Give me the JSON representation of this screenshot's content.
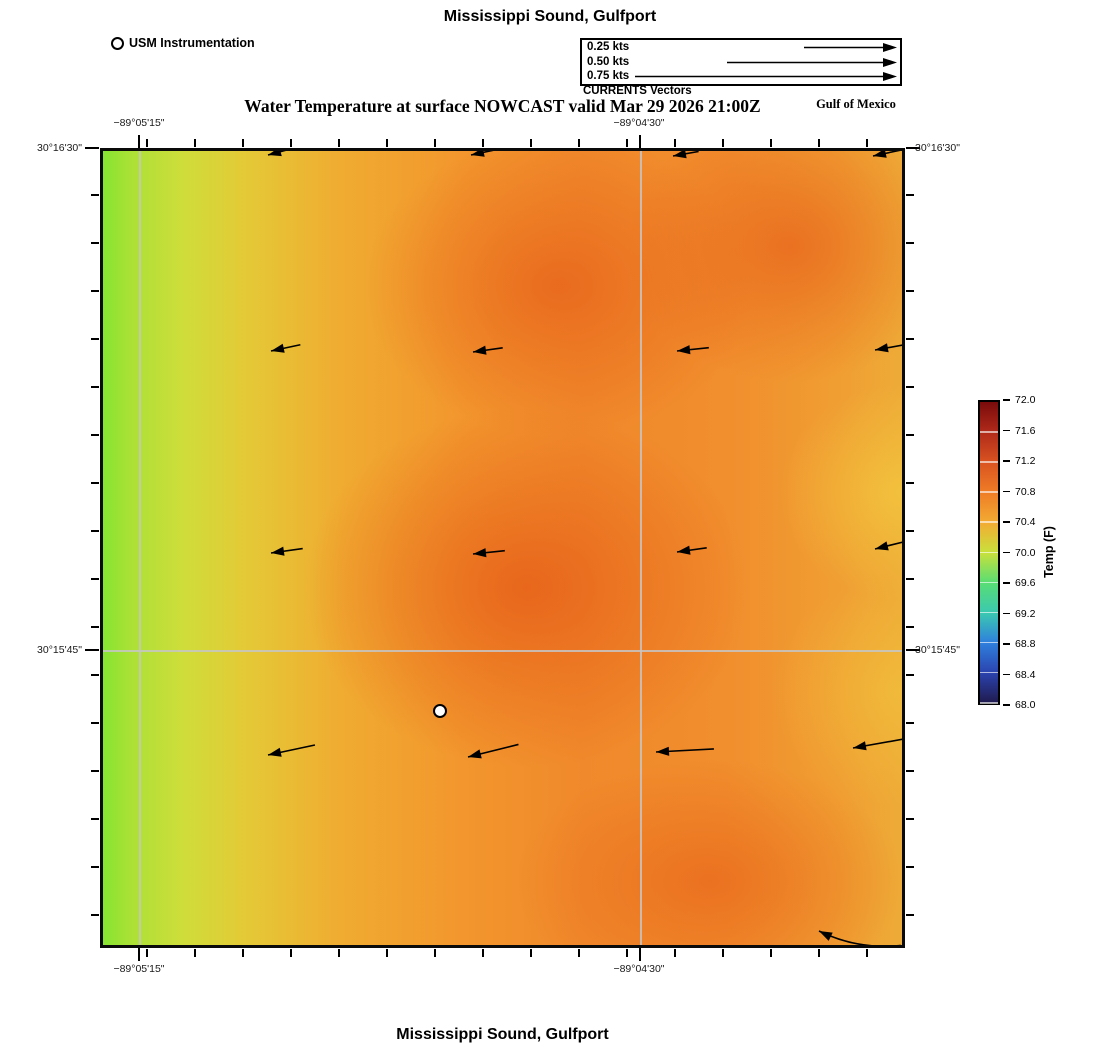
{
  "page": {
    "top_title": "Mississippi Sound, Gulfport",
    "bottom_title": "Mississippi Sound, Gulfport"
  },
  "header": {
    "station_legend": "USM Instrumentation",
    "vector_legend": {
      "caption": "CURRENTS Vectors",
      "speeds": [
        {
          "label": "0.25 kts",
          "tail_px": 93
        },
        {
          "label": "0.50 kts",
          "tail_px": 170
        },
        {
          "label": "0.75 kts",
          "tail_px": 262
        }
      ]
    },
    "subtitle": "Water Temperature at surface NOWCAST valid Mar 29 2026 21:00Z",
    "region_label": "Gulf of Mexico"
  },
  "axes": {
    "lat_top": "30°16'30\"",
    "lat_mid": "30°15'45\"",
    "lon_west": "−89°05'15\"",
    "lon_east": "−89°04'30\""
  },
  "colorbar": {
    "title": "Temp (F)",
    "tick_labels": [
      "72.0",
      "71.6",
      "71.2",
      "70.8",
      "70.4",
      "70.0",
      "69.6",
      "69.2",
      "68.8",
      "68.4",
      "68.0"
    ],
    "colors_top_to_bottom": [
      "#7a0b0b",
      "#b02a1a",
      "#d95321",
      "#ef7d26",
      "#f3ab33",
      "#c9e13c",
      "#59dd74",
      "#3bc9b0",
      "#2f7fdd",
      "#2b43ae",
      "#201a4e"
    ]
  },
  "chart_data": {
    "type": "heatmap",
    "title": "Water Temperature at surface NOWCAST valid Mar 29 2026 21:00Z",
    "region": "Mississippi Sound, Gulfport",
    "colorbar_label": "Temp (F)",
    "temp_range_f": [
      68.0,
      72.0
    ],
    "temp_tick_step_f": 0.4,
    "lat_gridlines": [
      "30°16'30\"",
      "30°15'45\""
    ],
    "lon_gridlines": [
      "−89°05'15\"",
      "−89°04'30\""
    ],
    "field_summary_f": {
      "west_edge": 70.0,
      "center_core": 71.3,
      "east_edge": 70.6
    },
    "legend_speeds_kts": [
      0.25,
      0.5,
      0.75
    ],
    "station": {
      "name": "USM Instrumentation",
      "x_pct": 42.2,
      "y_pct": 70.5
    },
    "vectors": [
      {
        "x": 165,
        "y": 4,
        "len": 30,
        "ang": -15
      },
      {
        "x": 368,
        "y": 4,
        "len": 28,
        "ang": -12
      },
      {
        "x": 570,
        "y": 5,
        "len": 26,
        "ang": -10
      },
      {
        "x": 770,
        "y": 5,
        "len": 30,
        "ang": -12
      },
      {
        "x": 168,
        "y": 200,
        "len": 30,
        "ang": -12
      },
      {
        "x": 370,
        "y": 201,
        "len": 30,
        "ang": -8
      },
      {
        "x": 574,
        "y": 200,
        "len": 32,
        "ang": -6
      },
      {
        "x": 772,
        "y": 199,
        "len": 30,
        "ang": -10
      },
      {
        "x": 168,
        "y": 402,
        "len": 32,
        "ang": -8
      },
      {
        "x": 370,
        "y": 403,
        "len": 32,
        "ang": -6
      },
      {
        "x": 574,
        "y": 401,
        "len": 30,
        "ang": -8
      },
      {
        "x": 772,
        "y": 398,
        "len": 34,
        "ang": -14
      },
      {
        "x": 165,
        "y": 604,
        "len": 48,
        "ang": -12
      },
      {
        "x": 365,
        "y": 606,
        "len": 52,
        "ang": -14
      },
      {
        "x": 553,
        "y": 601,
        "len": 58,
        "ang": -3
      },
      {
        "x": 750,
        "y": 597,
        "len": 62,
        "ang": -10
      },
      {
        "x": 716,
        "y": 780,
        "len": 83,
        "ang": 10,
        "curve": 12
      }
    ]
  }
}
